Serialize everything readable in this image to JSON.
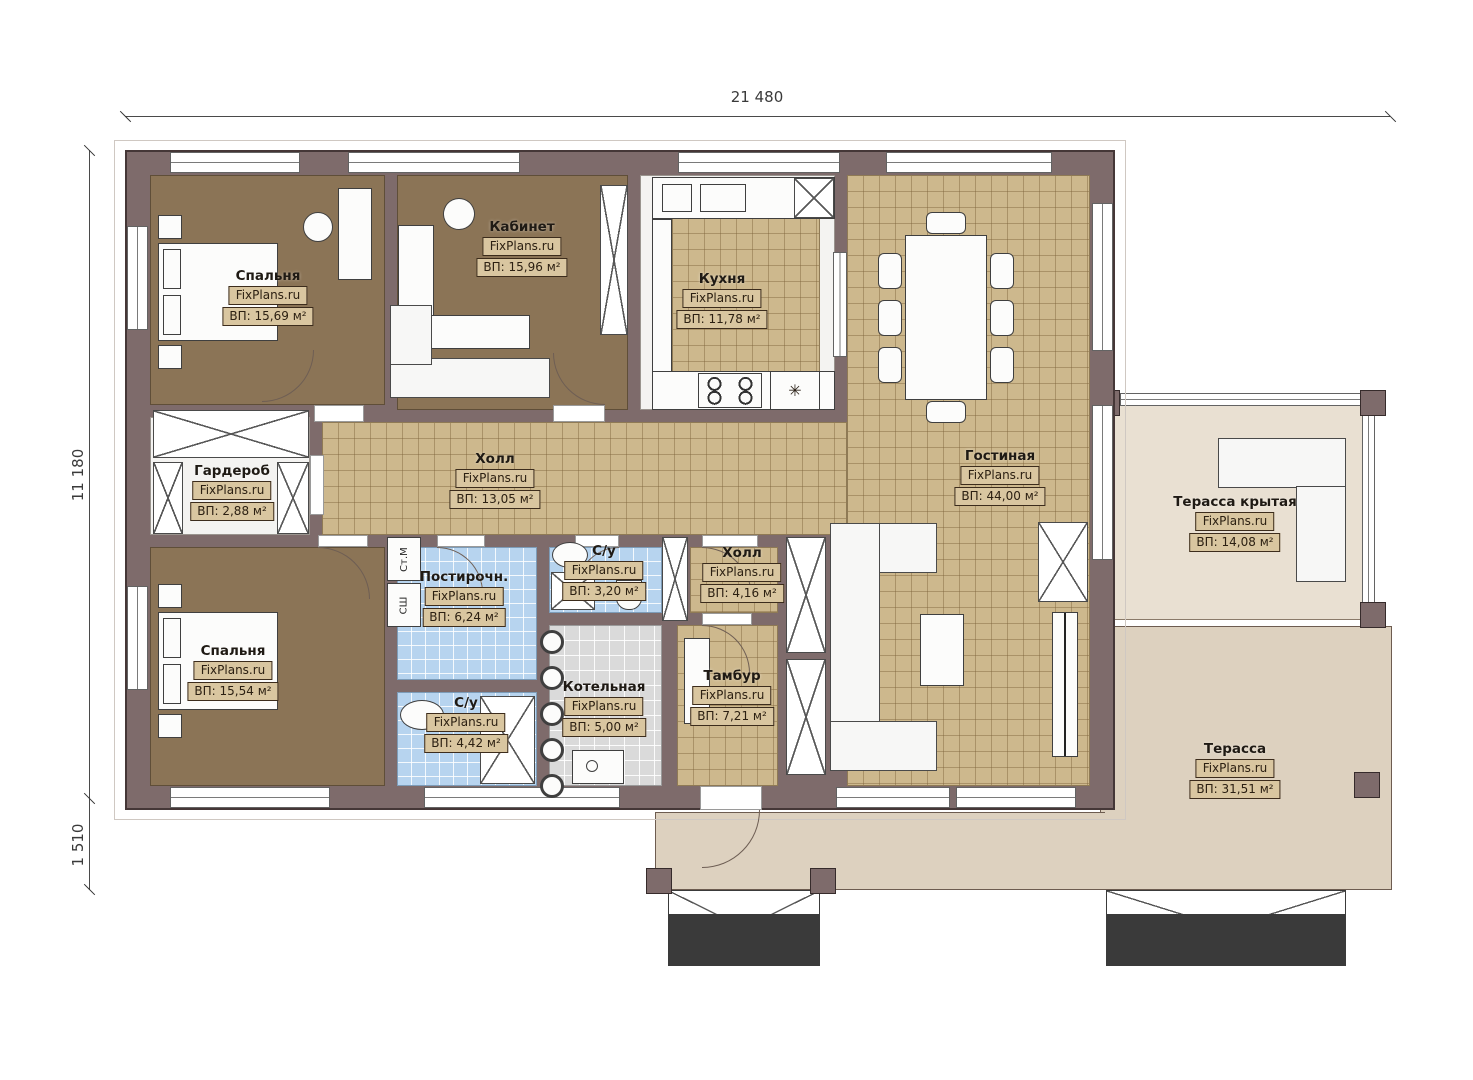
{
  "plan_title": "Floor plan",
  "brand": "FixPlans.ru",
  "dimensions": {
    "width_total": "21 480",
    "height_total": "11 180",
    "porch_depth": "1 510"
  },
  "rooms": [
    {
      "id": "bedroom1",
      "name": "Спальня",
      "brand": "FixPlans.ru",
      "area": "ВП: 15,69 м²"
    },
    {
      "id": "office",
      "name": "Кабинет",
      "brand": "FixPlans.ru",
      "area": "ВП: 15,96 м²"
    },
    {
      "id": "kitchen",
      "name": "Кухня",
      "brand": "FixPlans.ru",
      "area": "ВП: 11,78 м²"
    },
    {
      "id": "living",
      "name": "Гостиная",
      "brand": "FixPlans.ru",
      "area": "ВП: 44,00 м²"
    },
    {
      "id": "wardrobe",
      "name": "Гардероб",
      "brand": "FixPlans.ru",
      "area": "ВП: 2,88 м²"
    },
    {
      "id": "hall",
      "name": "Холл",
      "brand": "FixPlans.ru",
      "area": "ВП: 13,05 м²"
    },
    {
      "id": "bedroom2",
      "name": "Спальня",
      "brand": "FixPlans.ru",
      "area": "ВП: 15,54 м²"
    },
    {
      "id": "laundry",
      "name": "Постирочн.",
      "brand": "FixPlans.ru",
      "area": "ВП: 6,24 м²"
    },
    {
      "id": "bath1",
      "name": "С/у",
      "brand": "FixPlans.ru",
      "area": "ВП: 3,20 м²"
    },
    {
      "id": "hall2",
      "name": "Холл",
      "brand": "FixPlans.ru",
      "area": "ВП: 4,16 м²"
    },
    {
      "id": "bath2",
      "name": "С/у",
      "brand": "FixPlans.ru",
      "area": "ВП: 4,42 м²"
    },
    {
      "id": "boiler",
      "name": "Котельная",
      "brand": "FixPlans.ru",
      "area": "ВП: 5,00 м²"
    },
    {
      "id": "vestibule",
      "name": "Тамбур",
      "brand": "FixPlans.ru",
      "area": "ВП: 7,21 м²"
    },
    {
      "id": "terrace_covered",
      "name": "Терасса крытая",
      "brand": "FixPlans.ru",
      "area": "ВП: 14,08 м²"
    },
    {
      "id": "terrace",
      "name": "Терасса",
      "brand": "FixPlans.ru",
      "area": "ВП: 31,51 м²"
    }
  ],
  "appliances": {
    "washer": "Ст.М",
    "dryer": "СШ"
  },
  "icons": {
    "snowflake": "✳"
  },
  "colors": {
    "wall": "#7e6b6b",
    "wall_line": "#453737",
    "brown_floor": "#8b7456",
    "tan_tile": "#cdb88d",
    "blue_tile": "#b7d4ef",
    "gray_tile": "#dadada",
    "terrace": "#ddd1bf",
    "terrace_covered": "#e9e0d2",
    "label_box": "#d9c6a0"
  }
}
